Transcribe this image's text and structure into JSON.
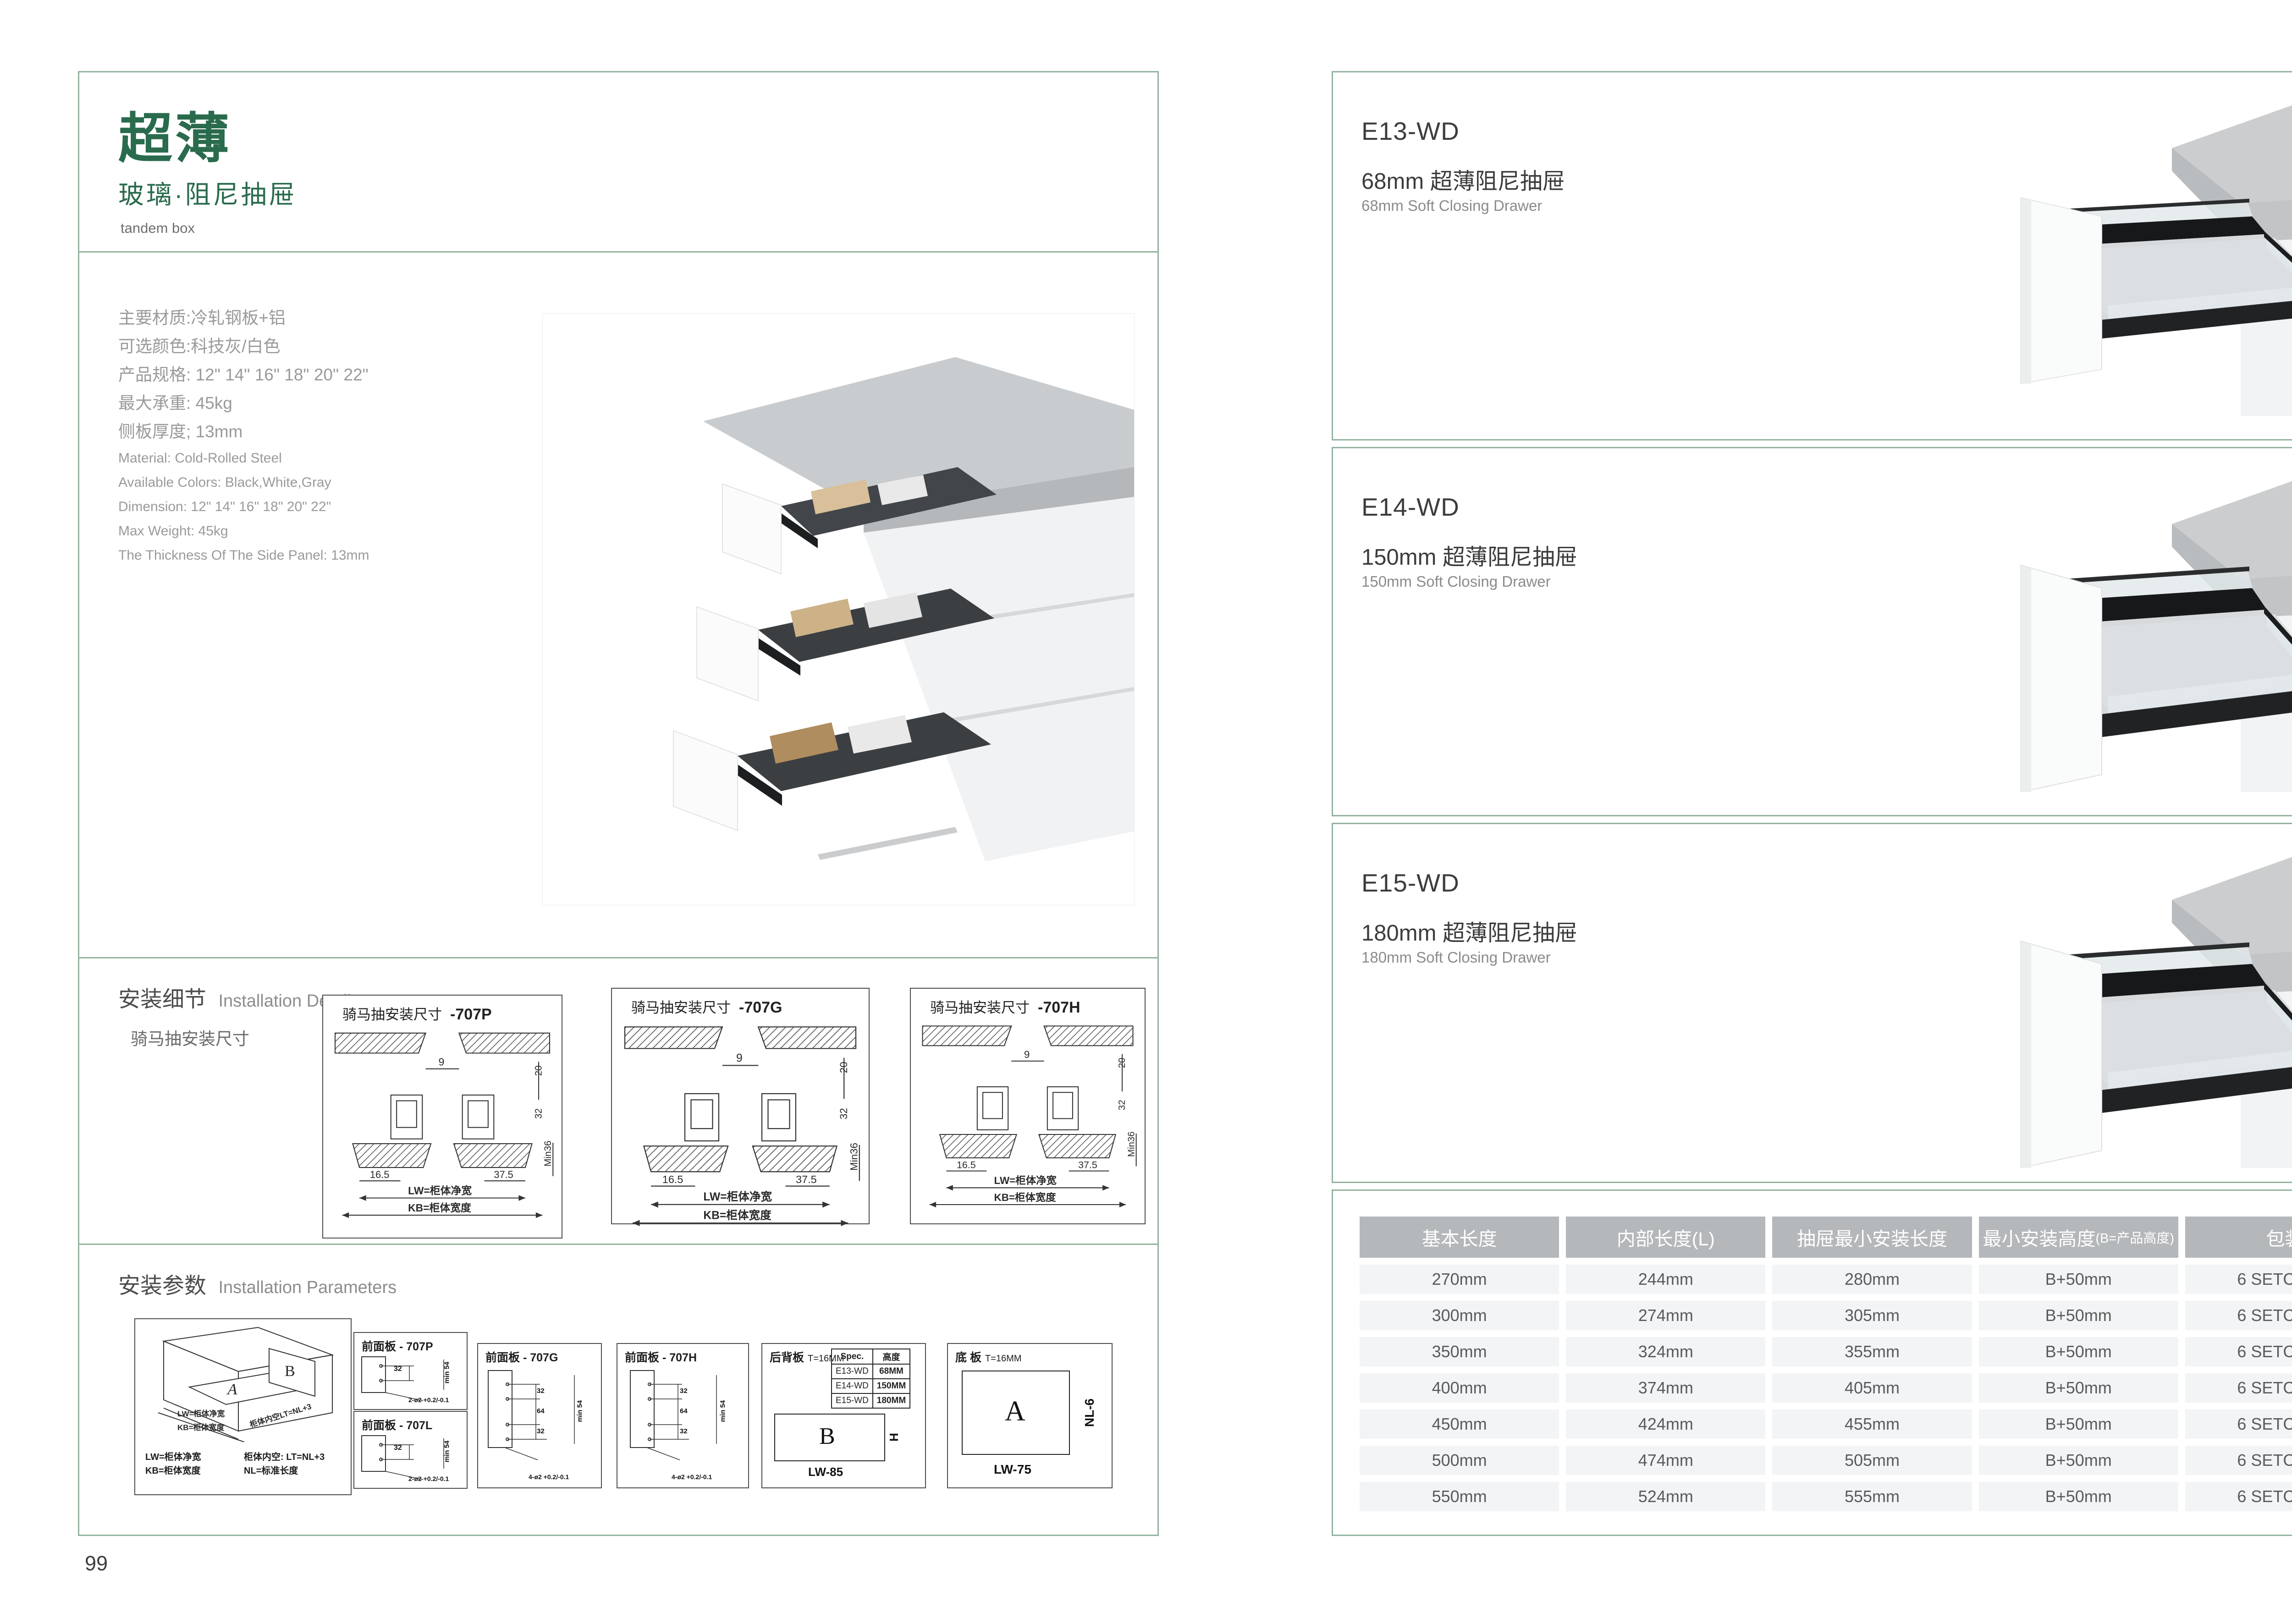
{
  "left": {
    "title": "超薄",
    "subtitle": "玻璃·阻尼抽屉",
    "subtitle_en": "tandem box",
    "specs_cn": [
      "主要材质:冷轧钢板+铝",
      "可选颜色:科技灰/白色",
      "产品规格: 12\" 14\" 16\" 18\" 20\" 22\"",
      "最大承重: 45kg",
      "侧板厚度; 13mm"
    ],
    "specs_en": [
      "Material: Cold-Rolled Steel",
      "Available Colors: Black,White,Gray",
      "Dimension: 12\" 14\" 16\" 18\" 20\" 22\"",
      "Max Weight: 45kg",
      "The Thickness Of The Side Panel: 13mm"
    ],
    "details_cn": "安装细节",
    "details_en": "Installation Details",
    "details_caption": "骑马抽安装尺寸",
    "params_cn": "安装参数",
    "params_en": "Installation Parameters",
    "drawings": [
      {
        "title": "骑马抽安装尺寸",
        "code": "-707P"
      },
      {
        "title": "骑马抽安装尺寸",
        "code": "-707G"
      },
      {
        "title": "骑马抽安装尺寸",
        "code": "-707H"
      }
    ],
    "diagram": {
      "d9": "9",
      "d20": "20",
      "d32": "32",
      "min36": "Min36",
      "d165": "16.5",
      "d375": "37.5",
      "lw": "LW=柜体净宽",
      "kb": "KB=柜体宽度"
    },
    "cabinet3d": {
      "a": "A",
      "b": "B",
      "arrow_lw": "LW=柜体净宽",
      "arrow_kb": "KB=柜体宽度",
      "arrow_lt": "柜体内空LT=NL+3",
      "legend": [
        "LW=柜体净宽",
        "柜体内空: LT=NL+3",
        "KB=柜体宽度",
        "NL=标准长度"
      ]
    },
    "front_panels": [
      {
        "title": "前面板",
        "code": "- 707P",
        "dim": "32",
        "min": "min 54",
        "note": "2-ø2 +0.2/-0.1"
      },
      {
        "title": "前面板",
        "code": "- 707L",
        "dim": "32",
        "min": "min 54",
        "note": "2-ø2 +0.2/-0.1"
      },
      {
        "title": "前面板",
        "code": "- 707G",
        "dims": [
          "32",
          "64",
          "32"
        ],
        "min": "min 54",
        "note": "4-ø2 +0.2/-0.1"
      },
      {
        "title": "前面板",
        "code": "- 707H",
        "dims": [
          "32",
          "64",
          "32"
        ],
        "min": "min 54",
        "note": "4-ø2 +0.2/-0.1"
      }
    ],
    "back_panel": {
      "title": "后背板",
      "thickness": "T=16MM",
      "spec_headers": [
        "Spec.",
        "高度"
      ],
      "spec_rows": [
        [
          "E13-WD",
          "68MM"
        ],
        [
          "E14-WD",
          "150MM"
        ],
        [
          "E15-WD",
          "180MM"
        ]
      ],
      "b": "B",
      "h": "H",
      "lw": "LW-85"
    },
    "bottom_panel": {
      "title": "底 板",
      "thickness": "T=16MM",
      "a": "A",
      "nl": "NL-6",
      "lw": "LW-75"
    },
    "page_number": "99"
  },
  "right": {
    "products": [
      {
        "model": "E13-WD",
        "name_cn": "68mm 超薄阻尼抽屉",
        "name_en": "68mm Soft Closing Drawer"
      },
      {
        "model": "E14-WD",
        "name_cn": "150mm 超薄阻尼抽屉",
        "name_en": "150mm Soft Closing Drawer"
      },
      {
        "model": "E15-WD",
        "name_cn": "180mm 超薄阻尼抽屉",
        "name_en": "180mm Soft Closing Drawer"
      }
    ],
    "table": {
      "headers": [
        "基本长度",
        "内部长度(L)",
        "抽屉最小安装长度",
        "最小安装高度",
        "包装"
      ],
      "header_note": "(B=产品高度)",
      "rows": [
        [
          "270mm",
          "244mm",
          "280mm",
          "B+50mm",
          "6 SETC/TNB"
        ],
        [
          "300mm",
          "274mm",
          "305mm",
          "B+50mm",
          "6 SETC/TNB"
        ],
        [
          "350mm",
          "324mm",
          "355mm",
          "B+50mm",
          "6 SETC/TNB"
        ],
        [
          "400mm",
          "374mm",
          "405mm",
          "B+50mm",
          "6 SETC/TNB"
        ],
        [
          "450mm",
          "424mm",
          "455mm",
          "B+50mm",
          "6 SETC/TNB"
        ],
        [
          "500mm",
          "474mm",
          "505mm",
          "B+50mm",
          "6 SETC/TNB"
        ],
        [
          "550mm",
          "524mm",
          "555mm",
          "B+50mm",
          "6 SETC/TNB"
        ]
      ]
    },
    "page_number": "100"
  },
  "colors": {
    "accent_green": "#2a6b4d",
    "border_green": "#93b29f",
    "table_header_bg": "#b4b8bb",
    "table_row_bg": "#f2f4f6"
  }
}
